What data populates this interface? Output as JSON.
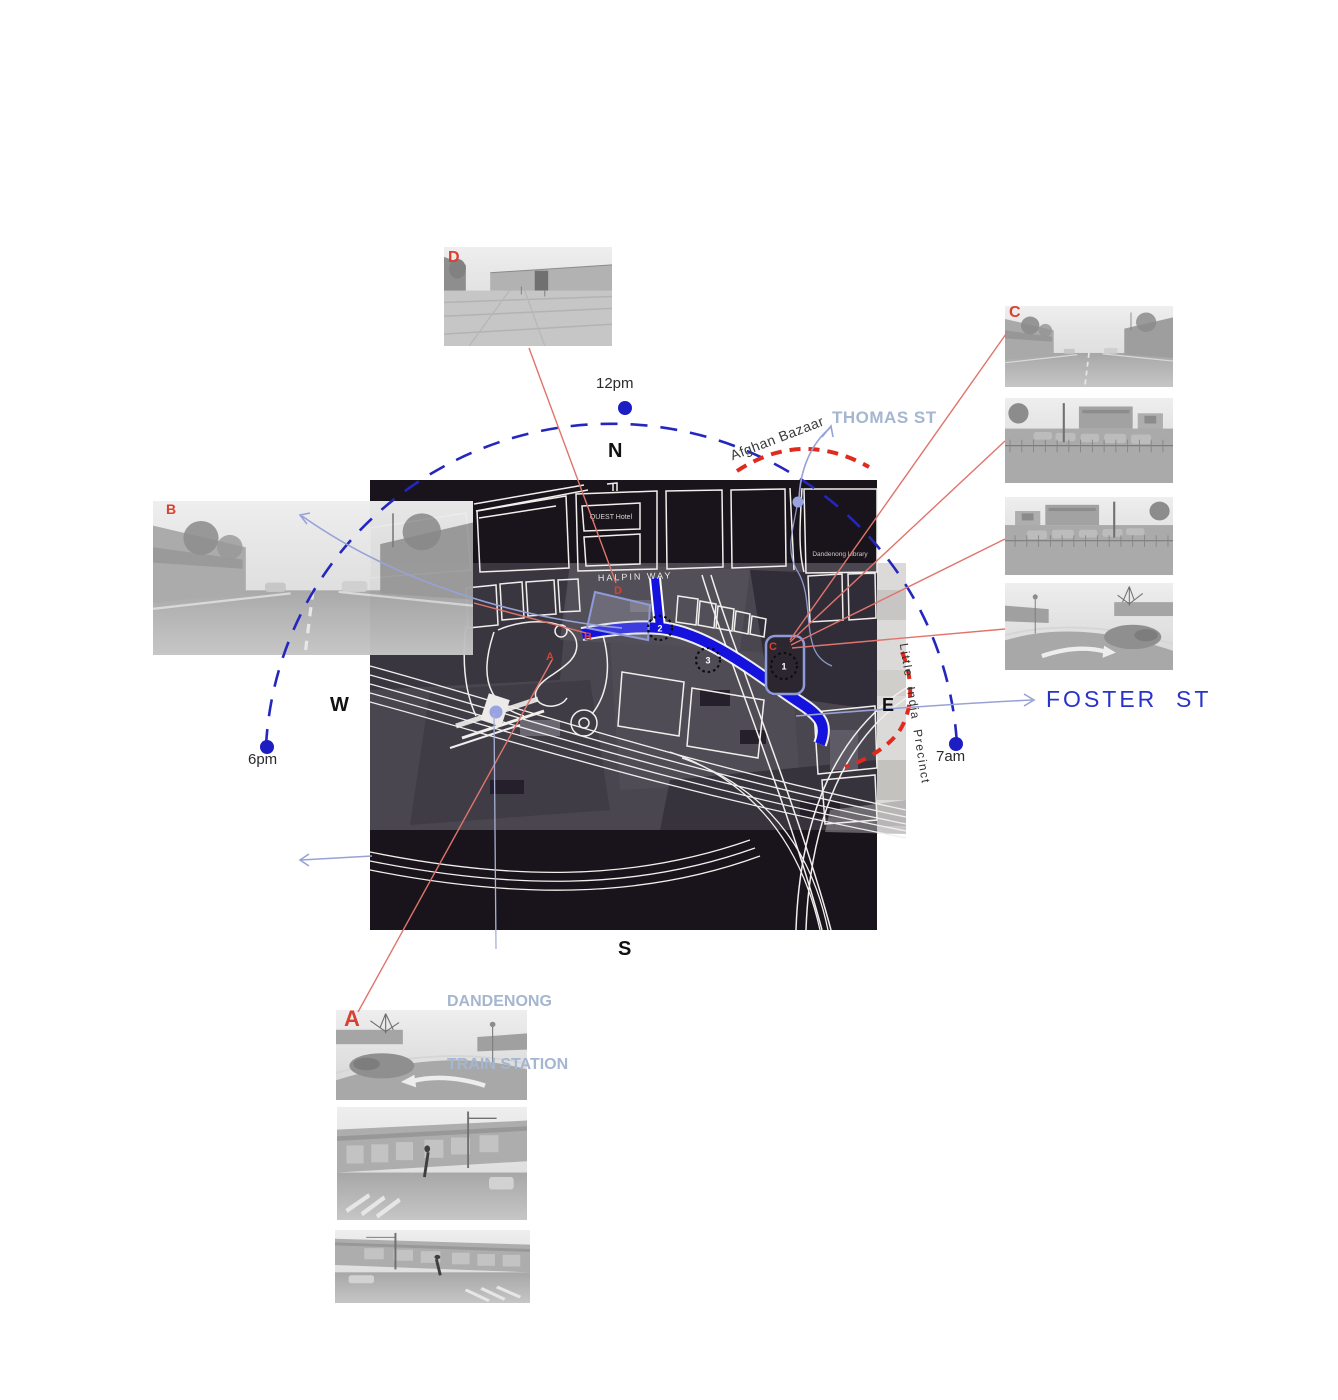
{
  "compass": {
    "north": "N",
    "east": "E",
    "south": "S",
    "west": "W"
  },
  "sun_path": {
    "noon": "12pm",
    "evening": "6pm",
    "morning": "7am"
  },
  "streets": {
    "thomas": "THOMAS ST",
    "foster": "FOSTER  ST",
    "halpin": "HALPIN WAY"
  },
  "precincts": {
    "afghan_bazaar": "Afghan Bazaar",
    "little_india": "Little  India  Precinct"
  },
  "station": {
    "line1": "DANDENONG",
    "line2": "TRAIN STATION"
  },
  "map": {
    "quest_hotel": "QUEST Hotel",
    "library": "Dandenong Library",
    "markers": {
      "a": "A",
      "b": "B",
      "c": "C",
      "d": "D"
    },
    "nodes": {
      "n1": "1",
      "n2": "2",
      "n3": "3"
    }
  },
  "viewpoints": {
    "a": "A",
    "b": "B",
    "c": "C",
    "d": "D"
  },
  "colors": {
    "accent_red": "#d9402f",
    "leader_red": "#e0746c",
    "dashed_red": "#e02a1e",
    "sun_blue": "#1d1dc4",
    "road_blue": "#1512dd",
    "periwinkle": "#9aa4d8",
    "label_blue_gray": "#a4b6d0",
    "foster_blue": "#2733c9"
  }
}
